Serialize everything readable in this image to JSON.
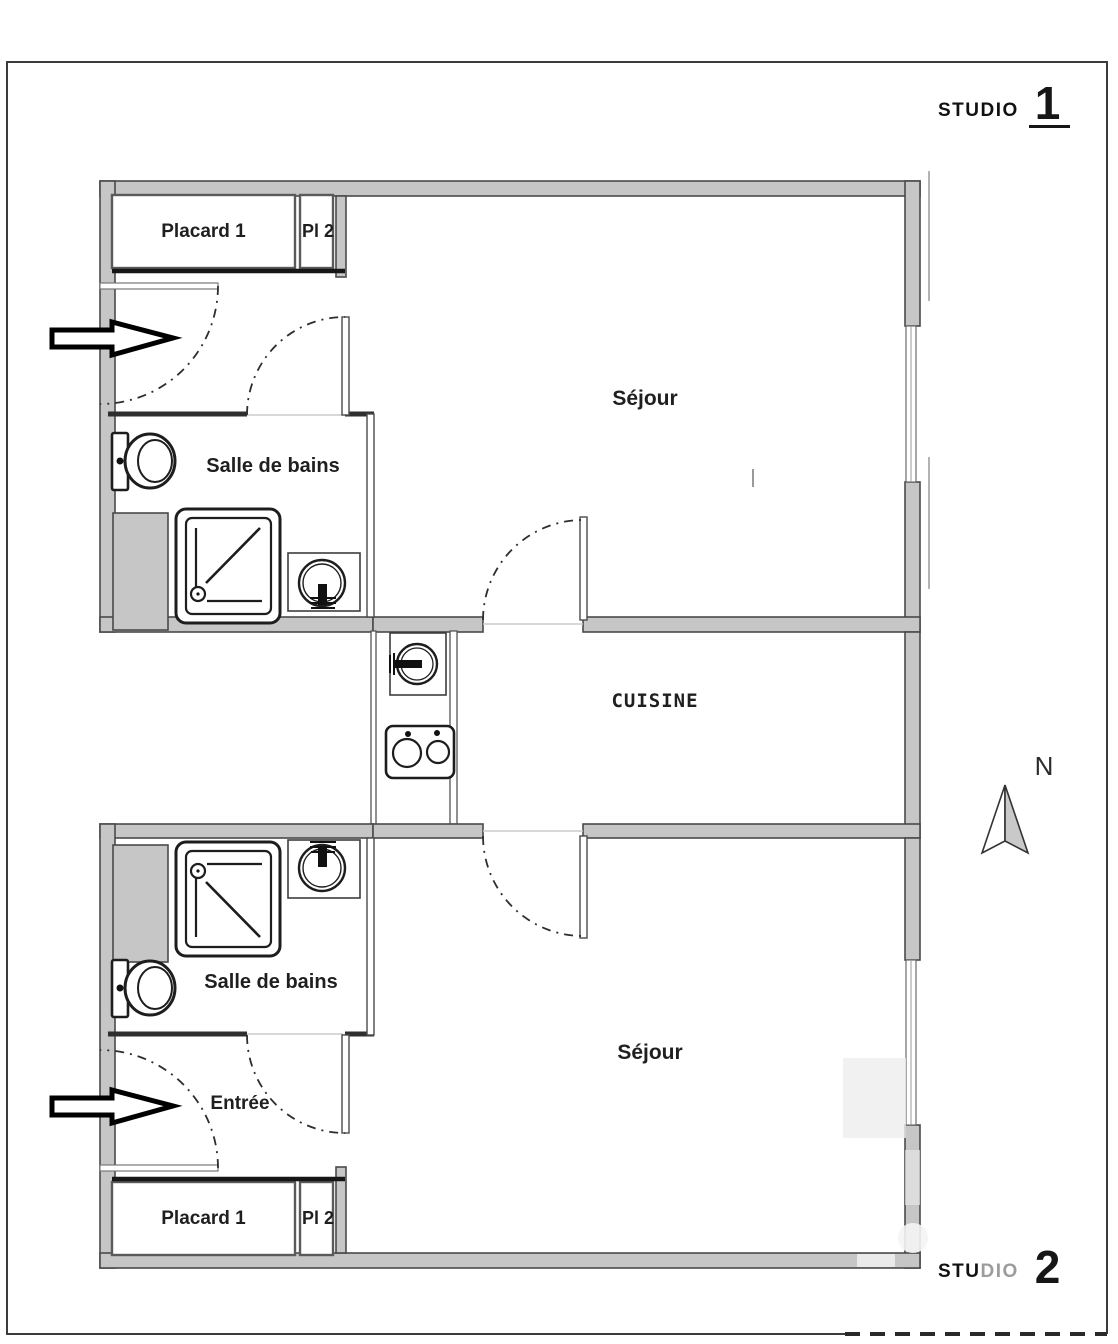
{
  "titles": {
    "studio1": {
      "label": "STUDIO",
      "number": "1"
    },
    "studio2": {
      "label_dark": "STU",
      "label_light": "DIO",
      "number": "2"
    }
  },
  "studio1": {
    "placard1": "Placard 1",
    "pl2": "Pl 2",
    "sejour": "Séjour",
    "salle_de_bains": "Salle de bains"
  },
  "studio2": {
    "placard1": "Placard 1",
    "pl2": "Pl 2",
    "sejour": "Séjour",
    "salle_de_bains": "Salle de bains",
    "entree": "Entrée"
  },
  "shared": {
    "cuisine": "CUISINE",
    "north": "N"
  },
  "colors": {
    "wall_fill": "#c6c6c6",
    "wall_line": "#4a4a4a",
    "thin_wall_line": "#555555",
    "door_arc": "#2e2e2e",
    "threshold_line": "#cccccc",
    "text": "#1a1a1a",
    "title_light_gray": "#9c9c9c",
    "north_arrow_gray": "#c9c9c9"
  }
}
